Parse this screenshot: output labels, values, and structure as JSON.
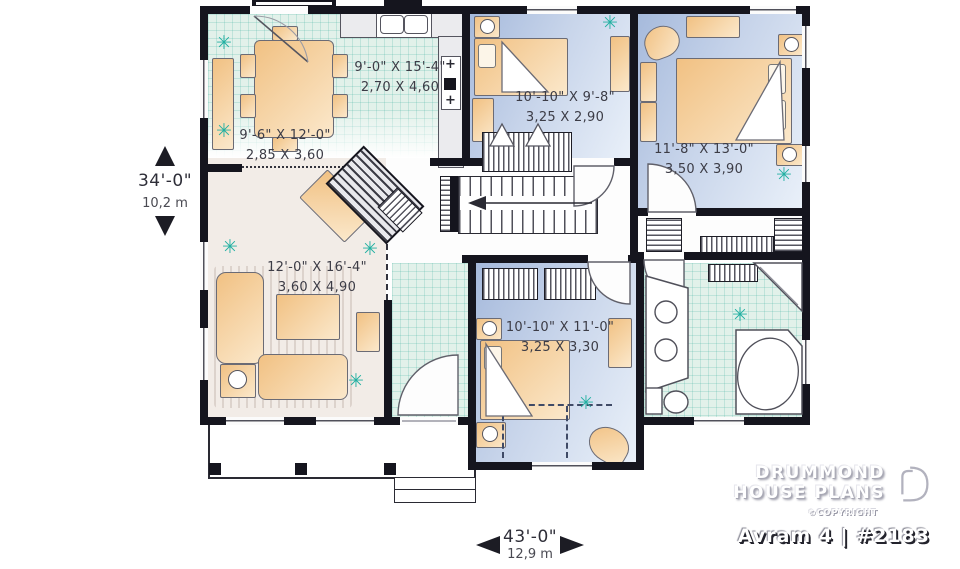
{
  "branding": {
    "line1": "DRUMMOND",
    "line2": "HOUSE PLANS",
    "copyright": "©COPYRIGHT",
    "plan_title": "Avram 4 | #2183"
  },
  "overall_dimensions": {
    "depth_ft": "34'-0\"",
    "depth_m": "10,2 m",
    "width_ft": "43'-0\"",
    "width_m": "12,9 m"
  },
  "rooms": {
    "kitchen": {
      "size_ft": "9'-0\" X 15'-4\"",
      "size_m": "2,70 X 4,60"
    },
    "dining": {
      "size_ft": "9'-6\" X 12'-0\"",
      "size_m": "2,85 X 3,60"
    },
    "bedroom_top": {
      "size_ft": "10'-10\" X 9'-8\"",
      "size_m": "3,25 X 2,90"
    },
    "master_bedroom": {
      "size_ft": "11'-8\" X 13'-0\"",
      "size_m": "3,50 X 3,90"
    },
    "living": {
      "size_ft": "12'-0\" X 16'-4\"",
      "size_m": "3,60 X 4,90"
    },
    "bedroom_bottom": {
      "size_ft": "10'-10\" X 11'-0\"",
      "size_m": "3,25 X 3,30"
    }
  },
  "icons": {
    "plant": "✳",
    "burner": "+"
  },
  "colors": {
    "wall": "#15151e",
    "tile_floor": "#e2f1ea",
    "bedroom_floor": "#b7c6e2",
    "living_floor": "#f2ece7",
    "furniture": "#f5c992",
    "plant": "#23b0a2"
  }
}
